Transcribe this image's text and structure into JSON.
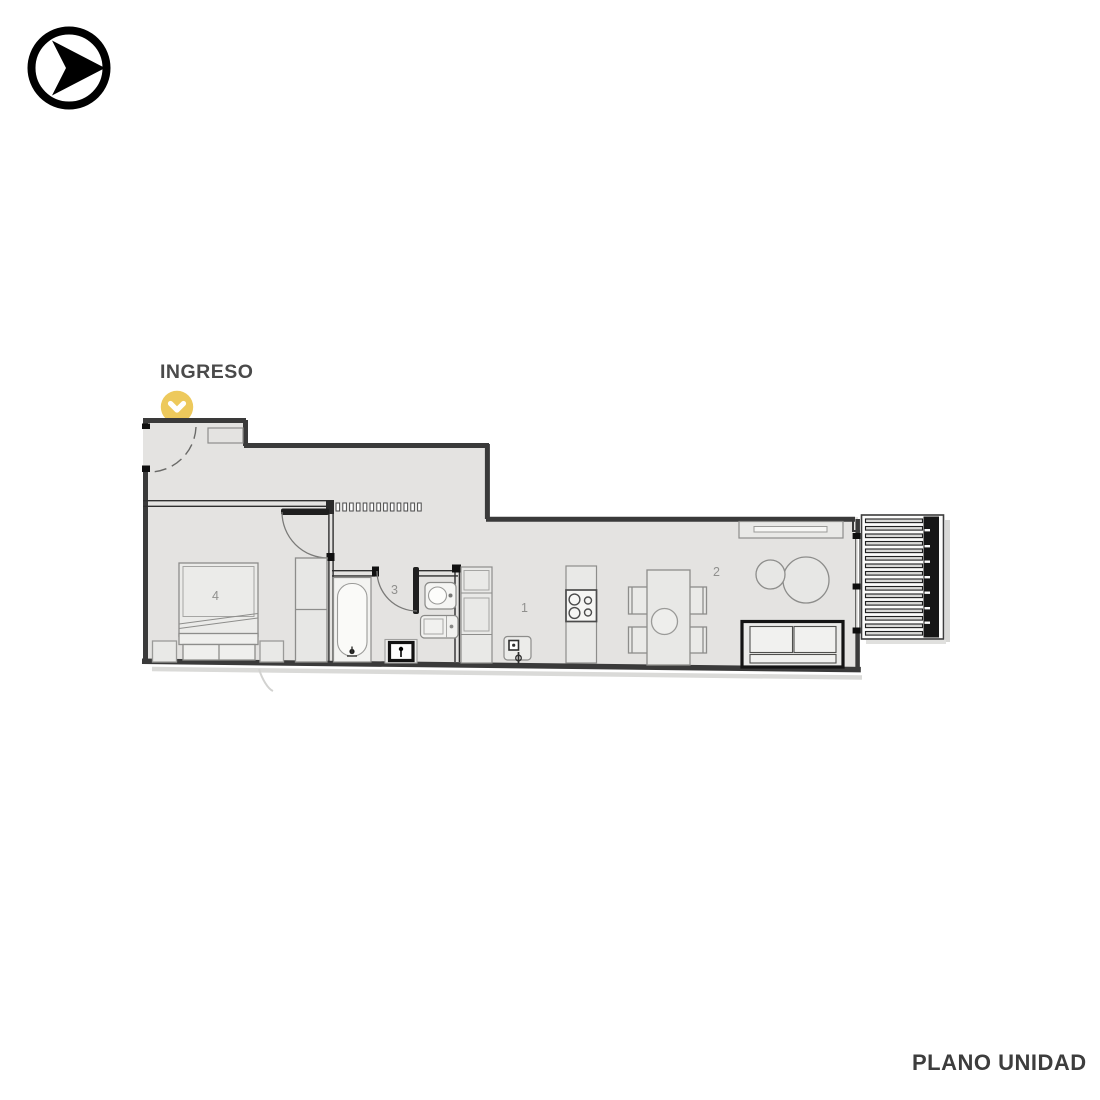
{
  "branding": {
    "logo_icon": "arrow-right-circle"
  },
  "entrance": {
    "label": "INGRESO",
    "marker_icon": "chevron-down-marker",
    "marker_color": "#edc95c"
  },
  "rooms": {
    "kitchen": "1",
    "living_dining": "2",
    "bathroom": "3",
    "bedroom": "4"
  },
  "footer": {
    "title": "PLANO UNIDAD"
  },
  "colors": {
    "background": "#ffffff",
    "floor": "#e4e3e1",
    "walls": "#3a3a3a",
    "accent_yellow": "#edc95c",
    "text_dark": "#4a4a4a",
    "room_label_gray": "#90908e"
  }
}
